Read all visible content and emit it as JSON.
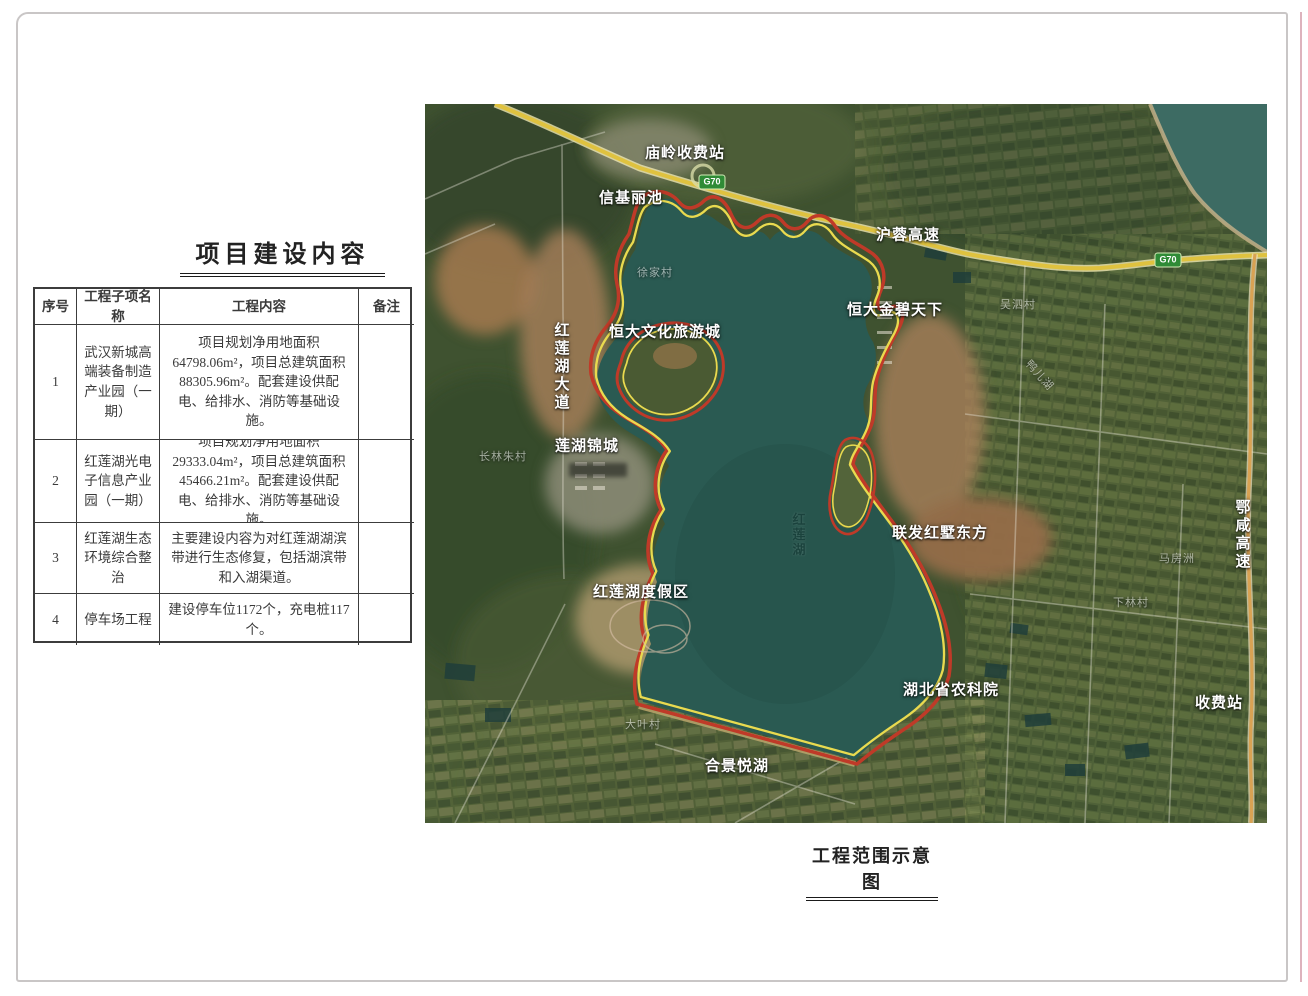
{
  "page": {
    "background": "#ffffff",
    "frame_color": "#c9c6c6"
  },
  "table_section": {
    "title": "项目建设内容",
    "headers": [
      "序号",
      "工程子项名称",
      "工程内容",
      "备注"
    ],
    "rows": [
      {
        "no": "1",
        "name": "武汉新城高端装备制造产业园（一期）",
        "content": "项目规划净用地面积64798.06m²，项目总建筑面积88305.96m²。配套建设供配电、给排水、消防等基础设施。",
        "note": ""
      },
      {
        "no": "2",
        "name": "红莲湖光电子信息产业园（一期）",
        "content": "项目规划净用地面积29333.04m²，项目总建筑面积45466.21m²。配套建设供配电、给排水、消防等基础设施。",
        "note": ""
      },
      {
        "no": "3",
        "name": "红莲湖生态环境综合整治",
        "content": "主要建设内容为对红莲湖湖滨带进行生态修复，包括湖滨带和入湖渠道。",
        "note": ""
      },
      {
        "no": "4",
        "name": "停车场工程",
        "content": "建设停车位1172个，充电桩117个。",
        "note": ""
      }
    ]
  },
  "map_section": {
    "caption": "工程范围示意图",
    "g70_badge": "G70",
    "labels": [
      {
        "text": "庙岭收费站"
      },
      {
        "text": "信基丽池"
      },
      {
        "text": "沪蓉高速"
      },
      {
        "text": "恒大金碧天下"
      },
      {
        "text": "恒大文化旅游城"
      },
      {
        "text": "红莲湖大道"
      },
      {
        "text": "莲湖锦城"
      },
      {
        "text": "联发红墅东方"
      },
      {
        "text": "红莲湖度假区"
      },
      {
        "text": "湖北省农科院"
      },
      {
        "text": "合景悦湖"
      },
      {
        "text": "收费站"
      },
      {
        "text": "鄂咸高速"
      },
      {
        "text": "长林朱村"
      },
      {
        "text": "大叶村"
      },
      {
        "text": "马房洲"
      },
      {
        "text": "下林村"
      },
      {
        "text": "吴泗村"
      },
      {
        "text": "鸭儿湖"
      },
      {
        "text": "红莲湖"
      },
      {
        "text": "徐家村"
      }
    ],
    "colors": {
      "boundary_red": "#bf3a28",
      "boundary_yellow": "#e9da4f",
      "highway_yellow": "#dfc23f",
      "expressway_orange": "#d9a253",
      "lake": "#2a5a52"
    }
  }
}
